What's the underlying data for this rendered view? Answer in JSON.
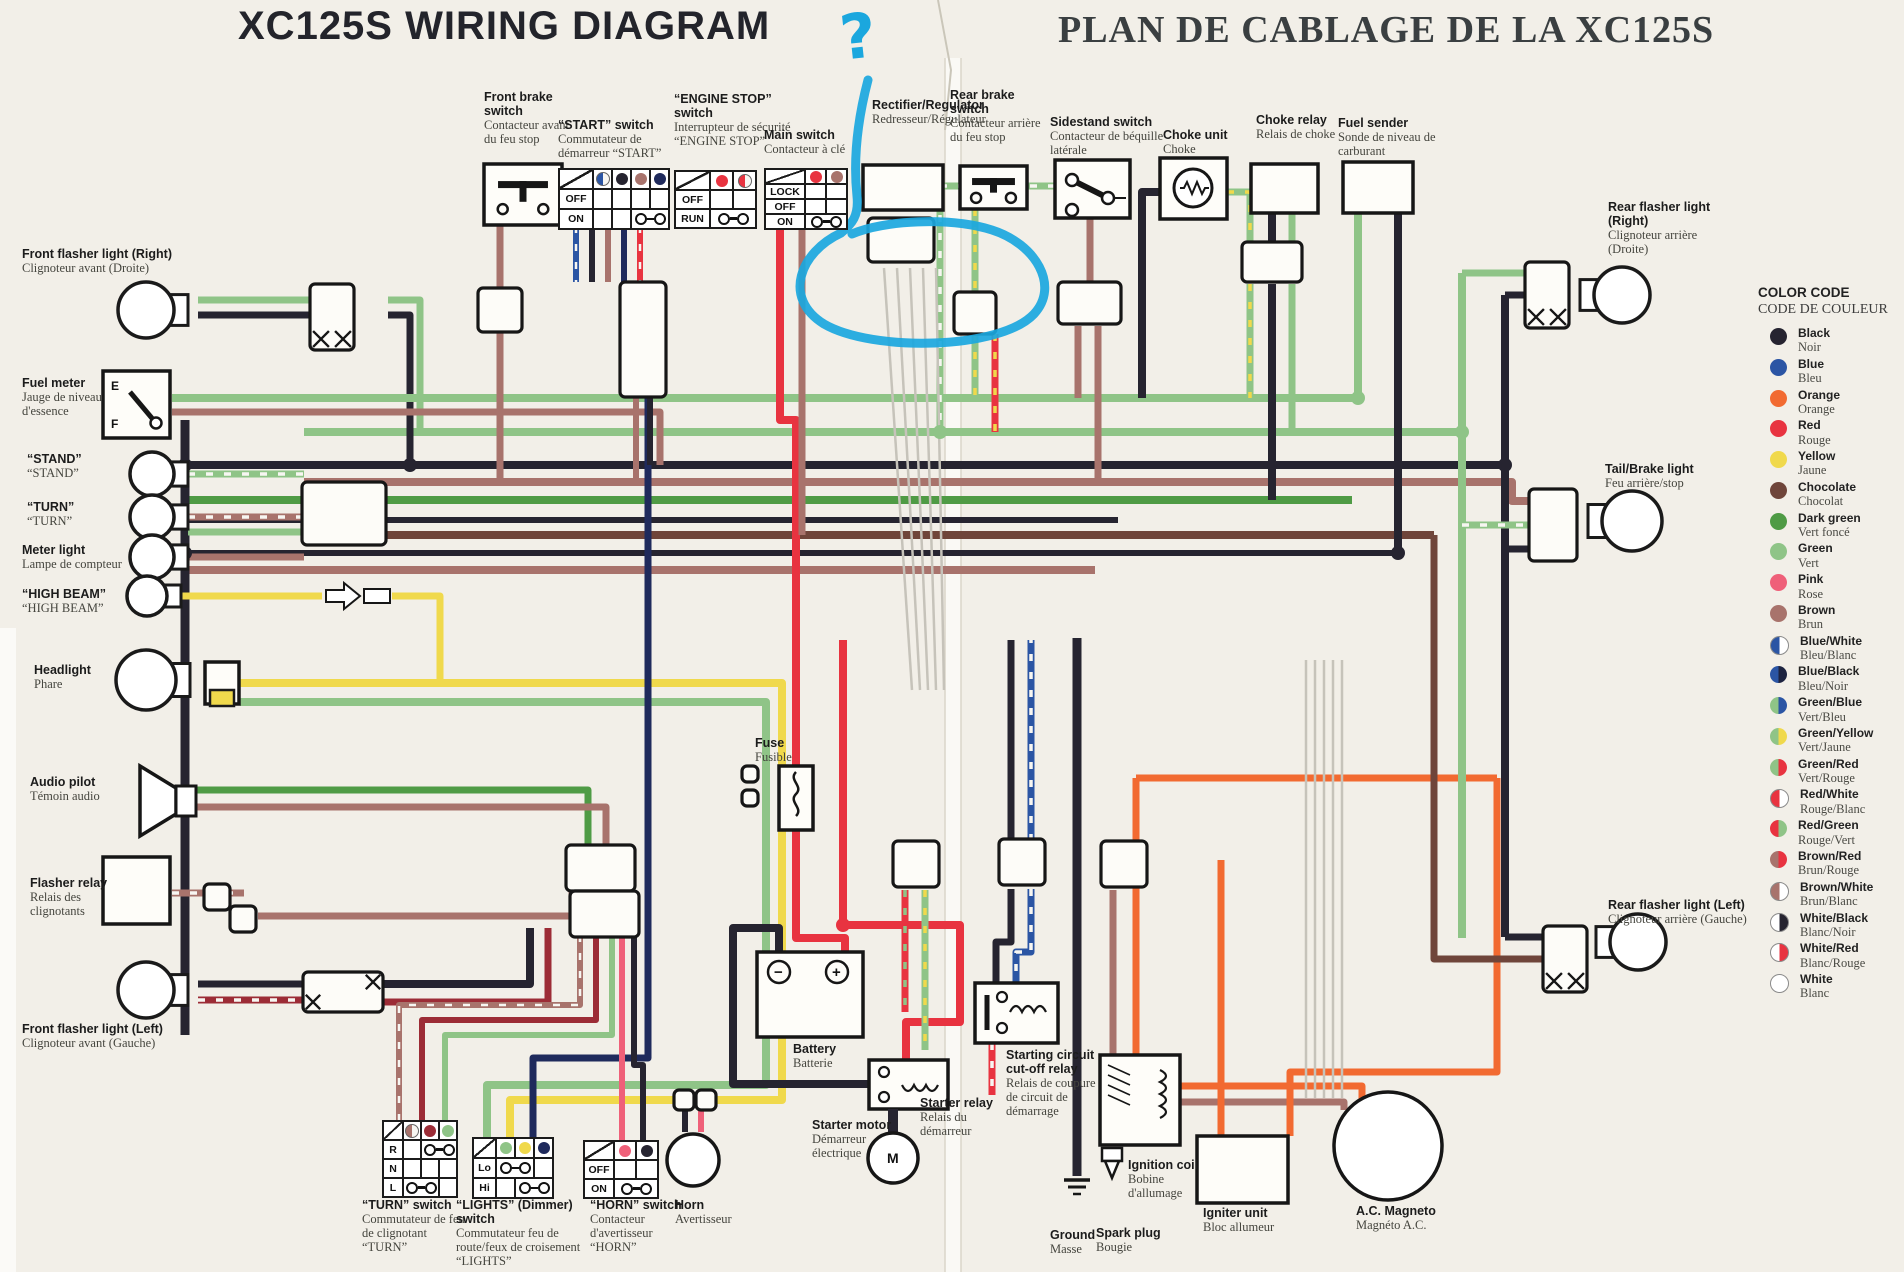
{
  "titles": {
    "en": "XC125S  WIRING DIAGRAM",
    "fr": "PLAN DE CABLAGE DE LA XC125S"
  },
  "annotation": {
    "mark": "?"
  },
  "components": {
    "front_brake_switch": {
      "en": "Front brake switch",
      "fr": "Contacteur avant du feu stop"
    },
    "start_switch": {
      "en": "“START” switch",
      "fr": "Commutateur de démarreur “START”",
      "rows": [
        "OFF",
        "ON"
      ],
      "pins": [
        "blue,white",
        "black",
        "brown",
        "blue_black"
      ]
    },
    "engine_stop_switch": {
      "en": "“ENGINE STOP” switch",
      "fr": "Interrupteur de sécurité “ENGINE STOP”",
      "rows": [
        "OFF",
        "RUN"
      ],
      "pins": [
        "red",
        "red,white"
      ]
    },
    "main_switch": {
      "en": "Main switch",
      "fr": "Contacteur à clé",
      "rows": [
        "LOCK",
        "OFF",
        "ON"
      ],
      "pins": [
        "red",
        "brown"
      ]
    },
    "rectifier_regulator": {
      "en": "Rectifier/Regulator",
      "fr": "Redresseur/Régulateur"
    },
    "rear_brake_switch": {
      "en": "Rear brake switch",
      "fr": "Contacteur arrière du feu stop"
    },
    "sidestand_switch": {
      "en": "Sidestand switch",
      "fr": "Contacteur de béquille latérale"
    },
    "choke_unit": {
      "en": "Choke unit",
      "fr": "Choke"
    },
    "choke_relay": {
      "en": "Choke relay",
      "fr": "Relais de choke"
    },
    "fuel_sender": {
      "en": "Fuel sender",
      "fr": "Sonde de niveau de carburant"
    },
    "front_flasher_right": {
      "en": "Front flasher light (Right)",
      "fr": "Clignoteur avant (Droite)"
    },
    "fuel_meter": {
      "en": "Fuel meter",
      "fr": "Jauge de niveau d'essence",
      "gauge": [
        "E",
        "F"
      ]
    },
    "stand_lamp": {
      "en": "“STAND”",
      "fr": "“STAND”"
    },
    "turn_lamp": {
      "en": "“TURN”",
      "fr": "“TURN”"
    },
    "meter_light": {
      "en": "Meter light",
      "fr": "Lampe de compteur"
    },
    "high_beam_lamp": {
      "en": "“HIGH BEAM”",
      "fr": "“HIGH BEAM”"
    },
    "headlight": {
      "en": "Headlight",
      "fr": "Phare"
    },
    "audio_pilot": {
      "en": "Audio pilot",
      "fr": "Témoin audio"
    },
    "flasher_relay": {
      "en": "Flasher relay",
      "fr": "Relais des clignotants"
    },
    "front_flasher_left": {
      "en": "Front flasher light (Left)",
      "fr": "Clignoteur avant (Gauche)"
    },
    "rear_flasher_right": {
      "en": "Rear flasher light (Right)",
      "fr": "Clignoteur arrière (Droite)"
    },
    "tail_brake_light": {
      "en": "Tail/Brake light",
      "fr": "Feu arrière/stop"
    },
    "rear_flasher_left": {
      "en": "Rear flasher light (Left)",
      "fr": "Clignoteur arrière (Gauche)"
    },
    "fuse": {
      "en": "Fuse",
      "fr": "Fusible"
    },
    "turn_switch": {
      "en": "“TURN” switch",
      "fr": "Commutateur de feu de clignotant “TURN”",
      "rows": [
        "R",
        "N",
        "L"
      ],
      "pins": [
        "brown,white",
        "dark_red",
        "green"
      ]
    },
    "lights_switch": {
      "en": "“LIGHTS” (Dimmer) switch",
      "fr": "Commutateur feu de route/feux de croisement “LIGHTS”",
      "rows": [
        "Lo",
        "Hi"
      ],
      "pins": [
        "green",
        "yellow",
        "blue_black"
      ]
    },
    "horn_switch": {
      "en": "“HORN” switch",
      "fr": "Contacteur d'avertisseur “HORN”",
      "rows": [
        "OFF",
        "ON"
      ],
      "pins": [
        "pink",
        "black"
      ]
    },
    "horn": {
      "en": "Horn",
      "fr": "Avertisseur"
    },
    "battery": {
      "en": "Battery",
      "fr": "Batterie",
      "terminals": [
        "−",
        "+"
      ]
    },
    "starter_motor": {
      "en": "Starter motor",
      "fr": "Démarreur électrique",
      "symbol": "M"
    },
    "starter_relay": {
      "en": "Starter relay",
      "fr": "Relais du démarreur"
    },
    "starting_cutoff_relay": {
      "en": "Starting circuit cut-off relay",
      "fr": "Relais de coupure de circuit de démarrage"
    },
    "ground": {
      "en": "Ground",
      "fr": "Masse"
    },
    "spark_plug": {
      "en": "Spark plug",
      "fr": "Bougie"
    },
    "ignition_coil": {
      "en": "Ignition coil",
      "fr": "Bobine d'allumage"
    },
    "igniter_unit": {
      "en": "Igniter unit",
      "fr": "Bloc allumeur"
    },
    "ac_magneto": {
      "en": "A.C. Magneto",
      "fr": "Magnéto A.C."
    }
  },
  "legend": {
    "title_en": "COLOR CODE",
    "title_fr": "CODE DE COULEUR",
    "entries": [
      {
        "en": "Black",
        "fr": "Noir",
        "colors": [
          "#262430"
        ]
      },
      {
        "en": "Blue",
        "fr": "Bleu",
        "colors": [
          "#2b55a4"
        ]
      },
      {
        "en": "Orange",
        "fr": "Orange",
        "colors": [
          "#f26a31"
        ]
      },
      {
        "en": "Red",
        "fr": "Rouge",
        "colors": [
          "#e83340"
        ]
      },
      {
        "en": "Yellow",
        "fr": "Jaune",
        "colors": [
          "#f0d94c"
        ]
      },
      {
        "en": "Chocolate",
        "fr": "Chocolat",
        "colors": [
          "#6f453a"
        ]
      },
      {
        "en": "Dark green",
        "fr": "Vert foncé",
        "colors": [
          "#4f9b45"
        ]
      },
      {
        "en": "Green",
        "fr": "Vert",
        "colors": [
          "#8fc487"
        ]
      },
      {
        "en": "Pink",
        "fr": "Rose",
        "colors": [
          "#ef6079"
        ]
      },
      {
        "en": "Brown",
        "fr": "Brun",
        "colors": [
          "#a8736c"
        ]
      },
      {
        "en": "Blue/White",
        "fr": "Bleu/Blanc",
        "colors": [
          "#2b55a4",
          "#ffffff"
        ]
      },
      {
        "en": "Blue/Black",
        "fr": "Bleu/Noir",
        "colors": [
          "#2b55a4",
          "#1d2340"
        ]
      },
      {
        "en": "Green/Blue",
        "fr": "Vert/Bleu",
        "colors": [
          "#8fc487",
          "#2b55a4"
        ]
      },
      {
        "en": "Green/Yellow",
        "fr": "Vert/Jaune",
        "colors": [
          "#8fc487",
          "#f0d94c"
        ]
      },
      {
        "en": "Green/Red",
        "fr": "Vert/Rouge",
        "colors": [
          "#8fc487",
          "#e83340"
        ]
      },
      {
        "en": "Red/White",
        "fr": "Rouge/Blanc",
        "colors": [
          "#e83340",
          "#ffffff"
        ]
      },
      {
        "en": "Red/Green",
        "fr": "Rouge/Vert",
        "colors": [
          "#e83340",
          "#8fc487"
        ]
      },
      {
        "en": "Brown/Red",
        "fr": "Brun/Rouge",
        "colors": [
          "#a8736c",
          "#e83340"
        ]
      },
      {
        "en": "Brown/White",
        "fr": "Brun/Blanc",
        "colors": [
          "#a8736c",
          "#ffffff"
        ]
      },
      {
        "en": "White/Black",
        "fr": "Blanc/Noir",
        "colors": [
          "#ffffff",
          "#262430"
        ]
      },
      {
        "en": "White/Red",
        "fr": "Blanc/Rouge",
        "colors": [
          "#ffffff",
          "#e83340"
        ]
      },
      {
        "en": "White",
        "fr": "Blanc",
        "colors": [
          "#ffffff"
        ]
      }
    ]
  },
  "wire_colors": {
    "black": "#262430",
    "blue": "#2b55a4",
    "blue_black": "#1f2a5c",
    "green": "#8fc487",
    "dark_green": "#4f9b45",
    "red": "#e83340",
    "dark_red": "#9c2c36",
    "yellow": "#f0d94c",
    "brown": "#a8736c",
    "chocolate": "#6f453a",
    "pink": "#ef6079",
    "orange": "#f26a31",
    "white": "#f7f6f2",
    "gray": "#c6c3ba"
  }
}
